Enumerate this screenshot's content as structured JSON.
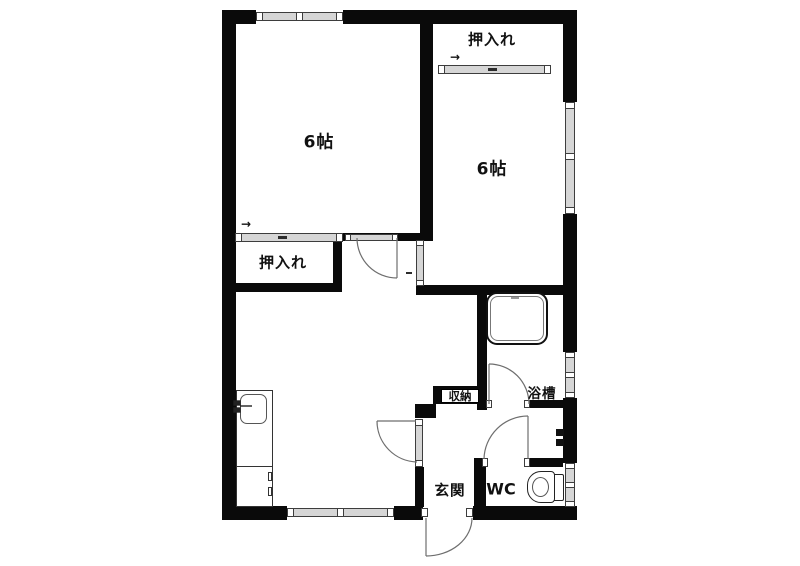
{
  "title": "2K apartment floor plan",
  "colors": {
    "wall": "#0a0a0a",
    "winfill": "#d6d6d6",
    "winline": "#3d3d3d",
    "line": "#777777",
    "text": "#111111",
    "bg": "#ffffff"
  },
  "labels": {
    "room_top_left": "6帖",
    "room_top_right": "6帖",
    "closet_top_right": "押入れ",
    "closet_middle_left": "押入れ",
    "storage": "収納",
    "bathtub": "浴槽",
    "entrance": "玄関",
    "toilet": "WC",
    "slide_arrow": "→"
  }
}
